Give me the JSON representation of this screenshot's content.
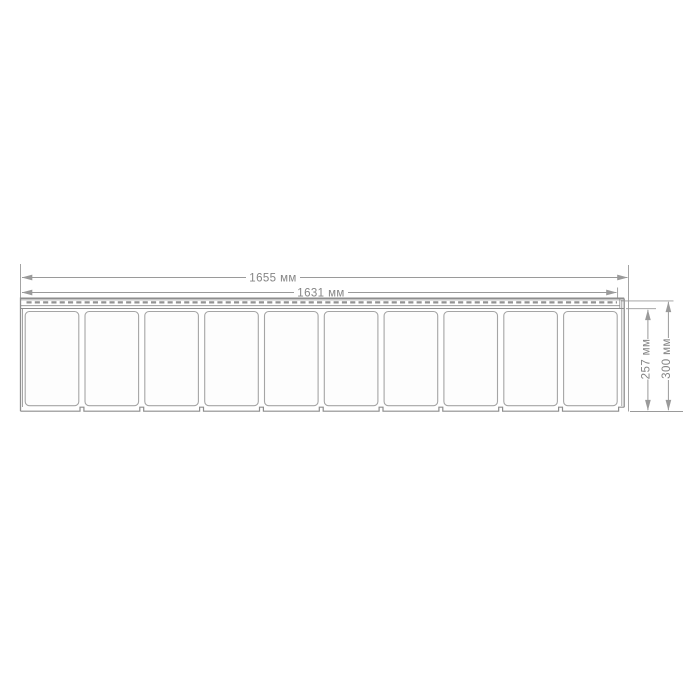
{
  "drawing": {
    "type": "technical-dimension-diagram",
    "panel": {
      "brick_count": 10
    },
    "dimensions": {
      "overall_width": "1655 мм",
      "visible_width": "1631 мм",
      "exposed_height": "257 мм",
      "overall_height": "300 мм"
    },
    "colors": {
      "background": "#ffffff",
      "line": "#8e8e8e",
      "dimension": "#9a9a9a",
      "text": "#858585",
      "slot_dash": "#939393",
      "brick_fill": "#fdfdfd",
      "brick_stroke": "#a5a5a5"
    }
  }
}
